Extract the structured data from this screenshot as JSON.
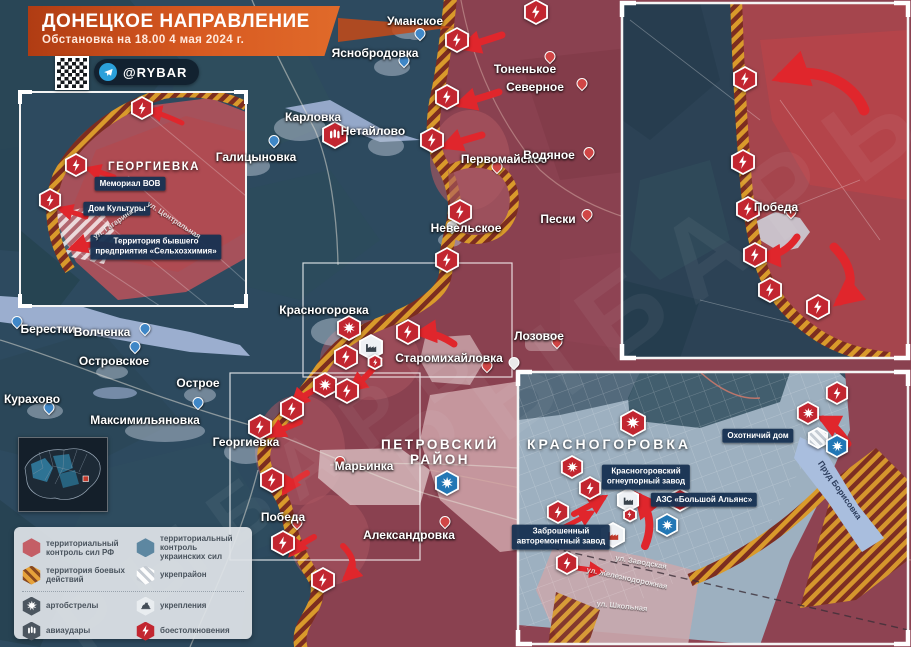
{
  "title": {
    "heading": "ДОНЕЦКОЕ НАПРАВЛЕНИЕ",
    "subtitle": "Обстановка на 18.00 4 мая 2024 г."
  },
  "badge": {
    "handle": "@RYBAR",
    "platform": "telegram"
  },
  "watermark": {
    "text": "РЫБАРЬ"
  },
  "colors": {
    "rf_territory": "#8a4150",
    "ua_territory": "#2d4a5f",
    "battle_zone": "#d99a2b",
    "clash": "#c22630",
    "arty_ua": "#2277b5",
    "arrow": "#e0262c",
    "title_bg": "#d85a21"
  },
  "legend": {
    "left": [
      {
        "swatch": "rf",
        "label": "территориальный контроль сил РФ"
      },
      {
        "swatch": "battle",
        "label": "территория боевых действий"
      },
      {
        "swatch": "arty-dark",
        "label": "артобстрелы"
      },
      {
        "swatch": "avia-dark",
        "label": "авиаудары"
      }
    ],
    "right": [
      {
        "swatch": "ua",
        "label": "территориальный контроль украинских сил"
      },
      {
        "swatch": "ukrep",
        "label": "укрепрайон"
      },
      {
        "swatch": "fort",
        "label": "укрепления"
      },
      {
        "swatch": "clash",
        "label": "боестолкновения"
      }
    ]
  },
  "map": {
    "towns": [
      {
        "name": "Уманское",
        "x": 415,
        "y": 21
      },
      {
        "name": "Яснобродовка",
        "x": 375,
        "y": 53
      },
      {
        "name": "Тоненькое",
        "x": 525,
        "y": 69
      },
      {
        "name": "Северное",
        "x": 535,
        "y": 87
      },
      {
        "name": "Карловка",
        "x": 313,
        "y": 117
      },
      {
        "name": "Нетайлово",
        "x": 373,
        "y": 131
      },
      {
        "name": "Галицыновка",
        "x": 256,
        "y": 157
      },
      {
        "name": "Первомайское",
        "x": 504,
        "y": 159
      },
      {
        "name": "Водяное",
        "x": 549,
        "y": 155
      },
      {
        "name": "Пески",
        "x": 558,
        "y": 219
      },
      {
        "name": "Невельское",
        "x": 466,
        "y": 228
      },
      {
        "name": "Берестки",
        "x": 48,
        "y": 329
      },
      {
        "name": "Волченка",
        "x": 102,
        "y": 332
      },
      {
        "name": "Островское",
        "x": 114,
        "y": 361
      },
      {
        "name": "Курахово",
        "x": 32,
        "y": 399
      },
      {
        "name": "Острое",
        "x": 198,
        "y": 383
      },
      {
        "name": "Максимильяновка",
        "x": 145,
        "y": 420
      },
      {
        "name": "Георгиевка",
        "x": 246,
        "y": 442
      },
      {
        "name": "Марьинка",
        "x": 364,
        "y": 466
      },
      {
        "name": "Победа",
        "x": 283,
        "y": 517
      },
      {
        "name": "Александровка",
        "x": 409,
        "y": 535
      },
      {
        "name": "Старомихайловка",
        "x": 449,
        "y": 358
      },
      {
        "name": "Лозовое",
        "x": 539,
        "y": 336
      },
      {
        "name": "Красногоровка",
        "x": 324,
        "y": 310
      },
      {
        "name": "Победа",
        "x": 776,
        "y": 207
      }
    ],
    "big_labels": [
      {
        "text": "ПЕТРОВСКИЙ\nРАЙОН",
        "x": 440,
        "y": 452,
        "cls": "big-region"
      },
      {
        "text": "КРАСНОГОРОВКА",
        "x": 609,
        "y": 444,
        "cls": "big-city"
      },
      {
        "text": "ГЕОРГИЕВКА",
        "x": 154,
        "y": 167,
        "cls": "big-inset"
      }
    ],
    "tags": [
      {
        "lines": [
          "Мемориал ВОВ"
        ],
        "x": 130,
        "y": 184
      },
      {
        "lines": [
          "Дом Культуры"
        ],
        "x": 117,
        "y": 209
      },
      {
        "lines": [
          "Территория бывшего",
          "предприятия «Сельхозхимия»"
        ],
        "x": 156,
        "y": 247
      },
      {
        "lines": [
          "Красногоровский",
          "огнеупорный завод"
        ],
        "x": 646,
        "y": 477
      },
      {
        "lines": [
          "АЗС «Большой Альянс»"
        ],
        "x": 704,
        "y": 500
      },
      {
        "lines": [
          "Заброшенный",
          "авторемонтный завод"
        ],
        "x": 561,
        "y": 537
      },
      {
        "lines": [
          "Охотничий дом"
        ],
        "x": 758,
        "y": 436
      }
    ],
    "streets": [
      {
        "text": "ул. Гагарина",
        "x": 113,
        "y": 224,
        "rot": -35
      },
      {
        "text": "ул. Центральная",
        "x": 174,
        "y": 220,
        "rot": 33
      },
      {
        "text": "ул. Заводская",
        "x": 641,
        "y": 562,
        "rot": 10
      },
      {
        "text": "ул. Железнодорожная",
        "x": 627,
        "y": 578,
        "rot": 12
      },
      {
        "text": "ул. Школьная",
        "x": 622,
        "y": 606,
        "rot": 6
      },
      {
        "text": "Пруд Борисовка",
        "x": 840,
        "y": 490,
        "rot": 55,
        "water": true
      }
    ],
    "pins": [
      {
        "x": 420,
        "y": 39,
        "c": "ua"
      },
      {
        "x": 404,
        "y": 66,
        "c": "ua"
      },
      {
        "x": 274,
        "y": 146,
        "c": "ua"
      },
      {
        "x": 17,
        "y": 327,
        "c": "ua"
      },
      {
        "x": 145,
        "y": 334,
        "c": "ua"
      },
      {
        "x": 135,
        "y": 352,
        "c": "ua"
      },
      {
        "x": 49,
        "y": 413,
        "c": "ua"
      },
      {
        "x": 198,
        "y": 408,
        "c": "ua"
      },
      {
        "x": 550,
        "y": 62,
        "c": "rf"
      },
      {
        "x": 582,
        "y": 89,
        "c": "rf"
      },
      {
        "x": 497,
        "y": 172,
        "c": "rf"
      },
      {
        "x": 589,
        "y": 158,
        "c": "rf"
      },
      {
        "x": 587,
        "y": 220,
        "c": "rf"
      },
      {
        "x": 452,
        "y": 232,
        "c": "w"
      },
      {
        "x": 340,
        "y": 467,
        "c": "rf"
      },
      {
        "x": 487,
        "y": 371,
        "c": "rf"
      },
      {
        "x": 514,
        "y": 368,
        "c": "w"
      },
      {
        "x": 557,
        "y": 347,
        "c": "rf"
      },
      {
        "x": 445,
        "y": 527,
        "c": "rf"
      },
      {
        "x": 297,
        "y": 528,
        "c": "rf"
      },
      {
        "x": 791,
        "y": 217,
        "c": "rf"
      }
    ],
    "markers": [
      {
        "t": "clash",
        "x": 536,
        "y": 12,
        "s": 26
      },
      {
        "t": "clash",
        "x": 457,
        "y": 40,
        "s": 26
      },
      {
        "t": "clash",
        "x": 447,
        "y": 97,
        "s": 26
      },
      {
        "t": "clash",
        "x": 432,
        "y": 140,
        "s": 26
      },
      {
        "t": "avia-rf",
        "x": 335,
        "y": 135,
        "s": 28
      },
      {
        "t": "clash",
        "x": 460,
        "y": 212,
        "s": 26
      },
      {
        "t": "clash",
        "x": 447,
        "y": 260,
        "s": 26
      },
      {
        "t": "arty-rf",
        "x": 349,
        "y": 328,
        "s": 26
      },
      {
        "t": "clash",
        "x": 408,
        "y": 332,
        "s": 26
      },
      {
        "t": "factory",
        "x": 371,
        "y": 347,
        "s": 26
      },
      {
        "t": "clash",
        "x": 375,
        "y": 362,
        "s": 16
      },
      {
        "t": "clash",
        "x": 346,
        "y": 357,
        "s": 26
      },
      {
        "t": "arty-rf",
        "x": 325,
        "y": 385,
        "s": 26
      },
      {
        "t": "clash",
        "x": 347,
        "y": 391,
        "s": 26
      },
      {
        "t": "clash",
        "x": 292,
        "y": 409,
        "s": 26
      },
      {
        "t": "clash",
        "x": 260,
        "y": 427,
        "s": 26
      },
      {
        "t": "clash",
        "x": 272,
        "y": 480,
        "s": 26
      },
      {
        "t": "clash",
        "x": 283,
        "y": 543,
        "s": 26
      },
      {
        "t": "clash",
        "x": 323,
        "y": 580,
        "s": 26
      },
      {
        "t": "arty-ua",
        "x": 447,
        "y": 483,
        "s": 26
      },
      {
        "t": "clash",
        "x": 142,
        "y": 108,
        "s": 24
      },
      {
        "t": "clash",
        "x": 76,
        "y": 165,
        "s": 24
      },
      {
        "t": "clash",
        "x": 50,
        "y": 200,
        "s": 24
      },
      {
        "t": "clash",
        "x": 745,
        "y": 79,
        "s": 26
      },
      {
        "t": "clash",
        "x": 743,
        "y": 162,
        "s": 26
      },
      {
        "t": "clash",
        "x": 748,
        "y": 209,
        "s": 26
      },
      {
        "t": "clash",
        "x": 755,
        "y": 255,
        "s": 26
      },
      {
        "t": "clash",
        "x": 770,
        "y": 290,
        "s": 26
      },
      {
        "t": "clash",
        "x": 818,
        "y": 307,
        "s": 26
      },
      {
        "t": "arty-rf",
        "x": 633,
        "y": 423,
        "s": 28
      },
      {
        "t": "arty-rf",
        "x": 572,
        "y": 467,
        "s": 24
      },
      {
        "t": "clash",
        "x": 590,
        "y": 488,
        "s": 24
      },
      {
        "t": "clash",
        "x": 558,
        "y": 512,
        "s": 24
      },
      {
        "t": "factory",
        "x": 628,
        "y": 500,
        "s": 24
      },
      {
        "t": "clash",
        "x": 630,
        "y": 515,
        "s": 15
      },
      {
        "t": "clash",
        "x": 680,
        "y": 500,
        "s": 24
      },
      {
        "t": "arty-ua",
        "x": 667,
        "y": 525,
        "s": 24
      },
      {
        "t": "factory-red",
        "x": 613,
        "y": 535,
        "s": 26
      },
      {
        "t": "clash",
        "x": 567,
        "y": 563,
        "s": 24
      },
      {
        "t": "arty-rf",
        "x": 808,
        "y": 413,
        "s": 24
      },
      {
        "t": "clash",
        "x": 837,
        "y": 393,
        "s": 24
      },
      {
        "t": "ukrep",
        "x": 818,
        "y": 438,
        "s": 22
      },
      {
        "t": "arty-ua",
        "x": 837,
        "y": 446,
        "s": 24
      }
    ]
  }
}
